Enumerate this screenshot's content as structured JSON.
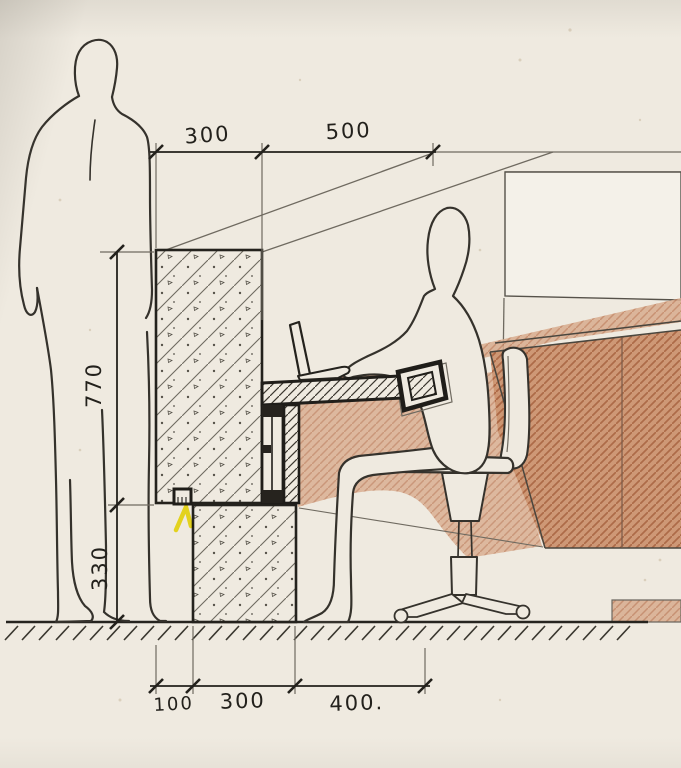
{
  "drawing": {
    "dimensions": {
      "top": [
        {
          "value": "300"
        },
        {
          "value": "500"
        }
      ],
      "left": [
        {
          "value": "770"
        },
        {
          "value": "330"
        }
      ],
      "bottom": [
        {
          "value": "100"
        },
        {
          "value": "300"
        },
        {
          "value": "400."
        }
      ]
    },
    "colors": {
      "paper": "#efeae0",
      "ink": "#2c2a25",
      "pencil": "#6f6a60",
      "sienna_light": "#d8ac8e",
      "sienna_dark": "#cc9470",
      "highlight_yellow": "#f2e209"
    }
  }
}
